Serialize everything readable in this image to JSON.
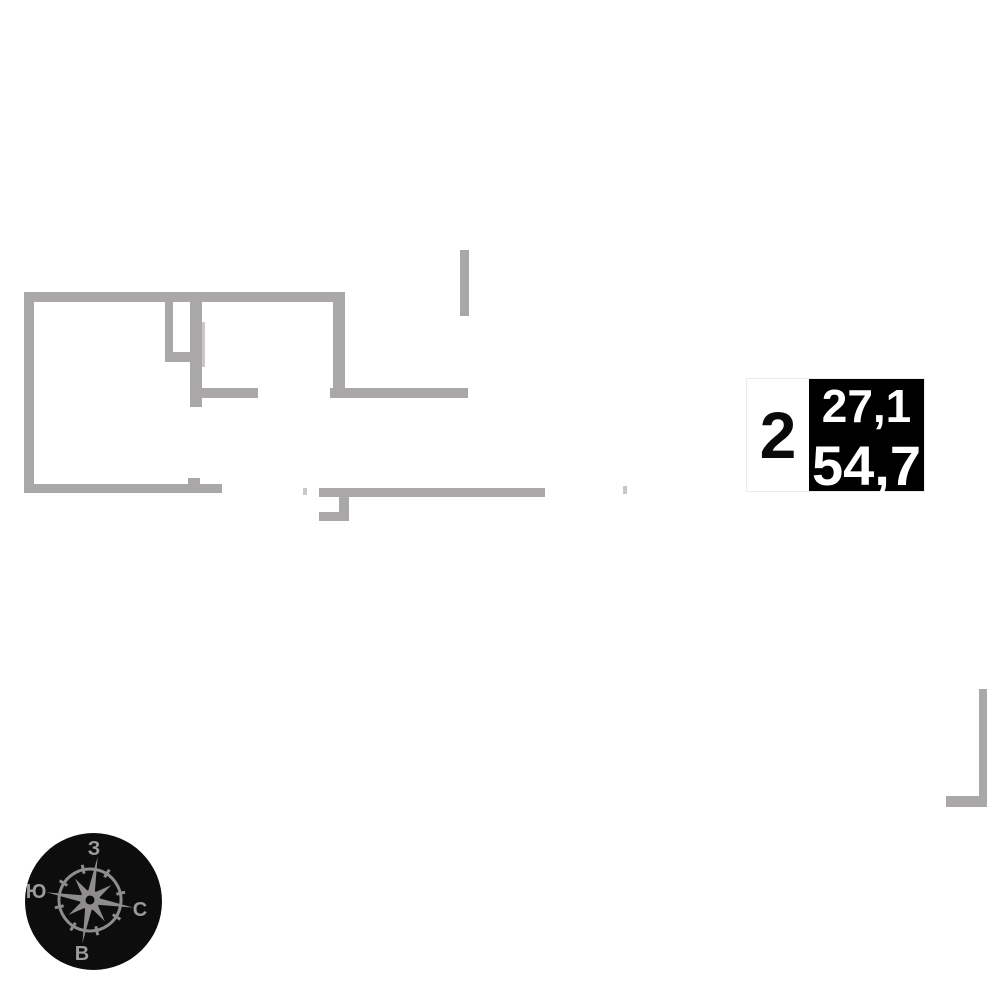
{
  "unit_card": {
    "rooms": "2",
    "upper_area": "27,1",
    "lower_area": "54,7"
  },
  "compass": {
    "top": "З",
    "left": "Ю",
    "right": "С",
    "bottom": "В"
  },
  "colors": {
    "wall": "#a9a7a8",
    "wall_light": "#c9c7c8",
    "card_bg": "#ffffff",
    "card_border": "#eceaea",
    "area_box_bg": "#000000",
    "area_text": "#ffffff",
    "rooms_text": "#0a0a0a",
    "compass_bg": "#0d0d0d",
    "compass_star": "#8e8c8c",
    "compass_letters": "#9c9a9a"
  },
  "floorplan": {
    "walls": [
      {
        "name": "wall-top",
        "x": 24,
        "y": 292,
        "w": 321,
        "h": 10,
        "shade": "wall"
      },
      {
        "name": "wall-left",
        "x": 24,
        "y": 292,
        "w": 10,
        "h": 201,
        "shade": "wall"
      },
      {
        "name": "wall-bottom-left",
        "x": 24,
        "y": 484,
        "w": 198,
        "h": 9,
        "shade": "wall"
      },
      {
        "name": "wall-bottom-left-stub",
        "x": 188,
        "y": 478,
        "w": 12,
        "h": 6,
        "shade": "wall"
      },
      {
        "name": "wall-closet-vertical",
        "x": 165,
        "y": 302,
        "w": 8,
        "h": 60,
        "shade": "wall"
      },
      {
        "name": "wall-closet-connector",
        "x": 165,
        "y": 352,
        "w": 25,
        "h": 10,
        "shade": "wall"
      },
      {
        "name": "wall-interior-vertical",
        "x": 190,
        "y": 292,
        "w": 12,
        "h": 115,
        "shade": "wall"
      },
      {
        "name": "door-opening-line",
        "x": 202,
        "y": 322,
        "w": 3,
        "h": 45,
        "shade": "wall_light"
      },
      {
        "name": "wall-hall-horizontal",
        "x": 202,
        "y": 388,
        "w": 56,
        "h": 10,
        "shade": "wall"
      },
      {
        "name": "wall-room-right-vertical",
        "x": 333,
        "y": 292,
        "w": 12,
        "h": 98,
        "shade": "wall"
      },
      {
        "name": "wall-lower-horizontal",
        "x": 330,
        "y": 388,
        "w": 138,
        "h": 10,
        "shade": "wall"
      },
      {
        "name": "wall-free-vertical",
        "x": 460,
        "y": 250,
        "w": 9,
        "h": 66,
        "shade": "wall"
      },
      {
        "name": "wall-bottom-middle",
        "x": 319,
        "y": 488,
        "w": 226,
        "h": 9,
        "shade": "wall"
      },
      {
        "name": "wall-hook-vertical",
        "x": 339,
        "y": 497,
        "w": 10,
        "h": 24,
        "shade": "wall"
      },
      {
        "name": "wall-hook-horizontal",
        "x": 319,
        "y": 512,
        "w": 30,
        "h": 9,
        "shade": "wall"
      },
      {
        "name": "door-mark-left",
        "x": 303,
        "y": 488,
        "w": 4,
        "h": 7,
        "shade": "wall_light"
      },
      {
        "name": "door-mark-right",
        "x": 623,
        "y": 486,
        "w": 4,
        "h": 8,
        "shade": "wall_light"
      },
      {
        "name": "wall-right-edge-vertical",
        "x": 979,
        "y": 689,
        "w": 8,
        "h": 118,
        "shade": "wall"
      },
      {
        "name": "wall-right-edge-horizontal",
        "x": 946,
        "y": 796,
        "w": 41,
        "h": 11,
        "shade": "wall"
      }
    ]
  }
}
